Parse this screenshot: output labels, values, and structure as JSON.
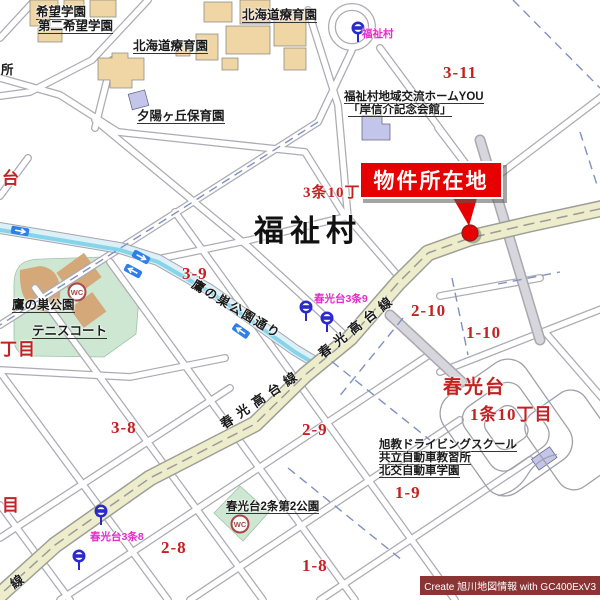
{
  "map": {
    "area_label": "福祉村",
    "callout_label": "物件所在地",
    "watermark": "Create 旭川地図情報 with GC400ExV3",
    "facilities": {
      "kibo_gakuen": "希望学園",
      "dai2_kibo_gakuen": "第二希望学園",
      "hokkaido_ryoikuen": "北海道療育園",
      "yuhigaoka_hoikuen": "夕陽ヶ丘保育園",
      "sho_partial": "所",
      "fukushimura_home_you": "福祉村地域交流ホームYOU",
      "kishi_kinenkaikan": "「岸信介記念会館」",
      "takanosu_koen": "鷹の巣公園",
      "tennis_court": "テニスコート",
      "shunkodai_2jo_park": "春光台2条第2公園",
      "kyokukyo_driving_school": "旭教ドライビングスクール",
      "kyoritsu_jidosha": "共立自動車教習所",
      "hokko_jidosha": "北交自動車学園"
    },
    "districts": {
      "d3_11": "3-11",
      "d3_9": "3-9",
      "d3_8": "3-8",
      "d2_10": "2-10",
      "d1_10": "1-10",
      "d2_9": "2-9",
      "d2_8": "2-8",
      "d1_9": "1-9",
      "d1_8": "1-8",
      "jo3_10": "3条10丁目",
      "shunkodai": "春光台",
      "jo1_10": "1条10丁目",
      "dai_partial": "台",
      "chome_partial": "丁目",
      "me_partial": "目"
    },
    "roads": {
      "shunko_takadai_line": "春光高台線",
      "takanosu_koen_dori": "鷹の巣公園通り",
      "sen_partial": "線"
    },
    "bus_stops": {
      "fukushimura": "福祉村",
      "shunkodai_3jo9": "春光台3条9",
      "shunkodai_3jo8": "春光台3条8"
    },
    "icons": {
      "wc": "WC"
    },
    "colors": {
      "main_road": "#EDEDCB",
      "building": "#EFD6A4",
      "public_building": "#C3C6EA",
      "park": "#CDE7D2",
      "water": "#DDF0F7",
      "water_stripe": "#86D4EA",
      "district_text": "#C22222",
      "bus_label_text": "#E52ACB",
      "callout_bg": "#E60000",
      "watermark_bg": "#8B3434",
      "boundary_dash": "#8090C5"
    }
  }
}
